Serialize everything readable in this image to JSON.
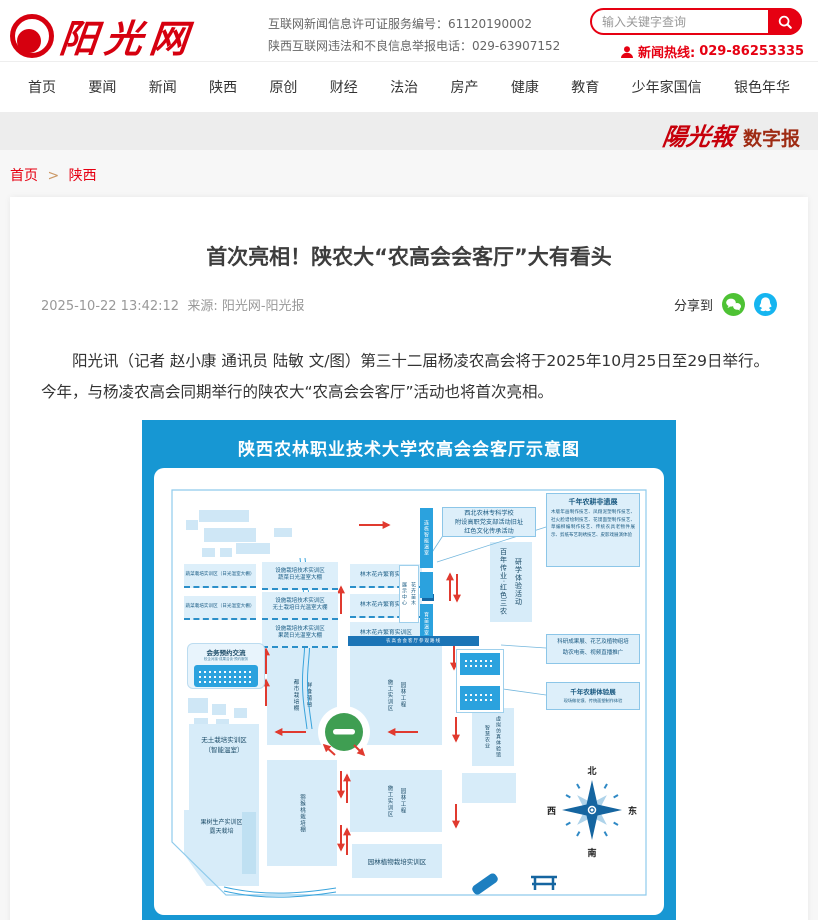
{
  "header": {
    "logo_text": "阳光网",
    "license_line1": "互联网新闻信息许可证服务编号：61120190002",
    "report_line": "陕西互联网违法和不良信息举报电话：029-63907152",
    "search_placeholder": "输入关键字查询",
    "hotline_label": "新闻热线:",
    "hotline_number": "029-86253335"
  },
  "nav": {
    "items": [
      "首页",
      "要闻",
      "新闻",
      "陕西",
      "原创",
      "财经",
      "法治",
      "房产",
      "健康",
      "教育",
      "少年家国信",
      "银色年华"
    ]
  },
  "masthead": {
    "paper_name": "陽光報",
    "digital_label": "数字报"
  },
  "breadcrumb": {
    "home": "首页",
    "separator": ">",
    "current": "陕西"
  },
  "article": {
    "title": "首次亮相！陕农大“农高会会客厅”大有看头",
    "date": "2025-10-22 13:42:12",
    "source": "来源: 阳光网-阳光报",
    "share_label": "分享到",
    "paragraph": "阳光讯（记者 赵小康 通讯员 陆敏 文/图）第三十二届杨凌农高会将于2025年10月25日至29日举行。今年，与杨凌农高会同期举行的陕农大“农高会会客厅”活动也将首次亮相。"
  },
  "map": {
    "title": "陕西农林职业技术大学农高会会客厅示意图",
    "boxes": {
      "veg": "蔬菜栽培实训区（日光温室大棚）",
      "fac_title": "设施栽培技术实训区",
      "fac_sub1": "蔬菜日光温室大棚",
      "fac_sub2": "无土栽培日光温室大棚",
      "fac_sub3": "果蔬日光温室大棚",
      "forest": "林木花卉繁育实训区",
      "red_site1": "西北农林专科学校",
      "red_site2": "附设高职党支部活动旧址",
      "red_site3": "红色文化传承活动",
      "century_left": "百年传业·红色三农",
      "century_right": "研学体验活动",
      "heritage_title": "千年农耕非遗展",
      "heritage_body": "木版年画制作技艺、凤翔泥塑制作技艺、社火脸谱绘制技艺、花馍面塑制作技艺、草编柳编制作技艺、传统农具老物件展示、剪纸布艺刺绣技艺、皮影戏展演体验",
      "route_bar": "农高会会客厅参观路线",
      "meeting_title": "会务预约交流",
      "meeting_sub": "校企对接·成果洽谈·预约服务",
      "soilless1": "无土栽培实训区",
      "soilless2": "（智能温室）",
      "fruit1": "果树生产实训区",
      "fruit2": "露天栽培",
      "grape_left": "都市栽培棚",
      "grape_right": "鲜食葡萄",
      "kiwi": "猕猴桃栽培棚",
      "landscape_left": "施工实训区",
      "landscape_right": "园林工程",
      "plant_cult": "园林植物栽培实训区",
      "smart_left": "智慧农业",
      "smart_right": "虚拟仿真体验馆",
      "sci_line1": "科研成果展、花艺及植物组培",
      "sci_line2": "助农电商、视频直播推广",
      "exp_title": "千年农耕体验展",
      "exp_sub": "现场做花馍、传统面塑制作体验",
      "bar_a": "连栋智能温室",
      "bar_b": "育苗温室",
      "vbox_left": "展示中心",
      "vbox_right": "花卉苗木",
      "compass": {
        "n": "北",
        "s": "南",
        "w": "西",
        "e": "东"
      }
    }
  }
}
